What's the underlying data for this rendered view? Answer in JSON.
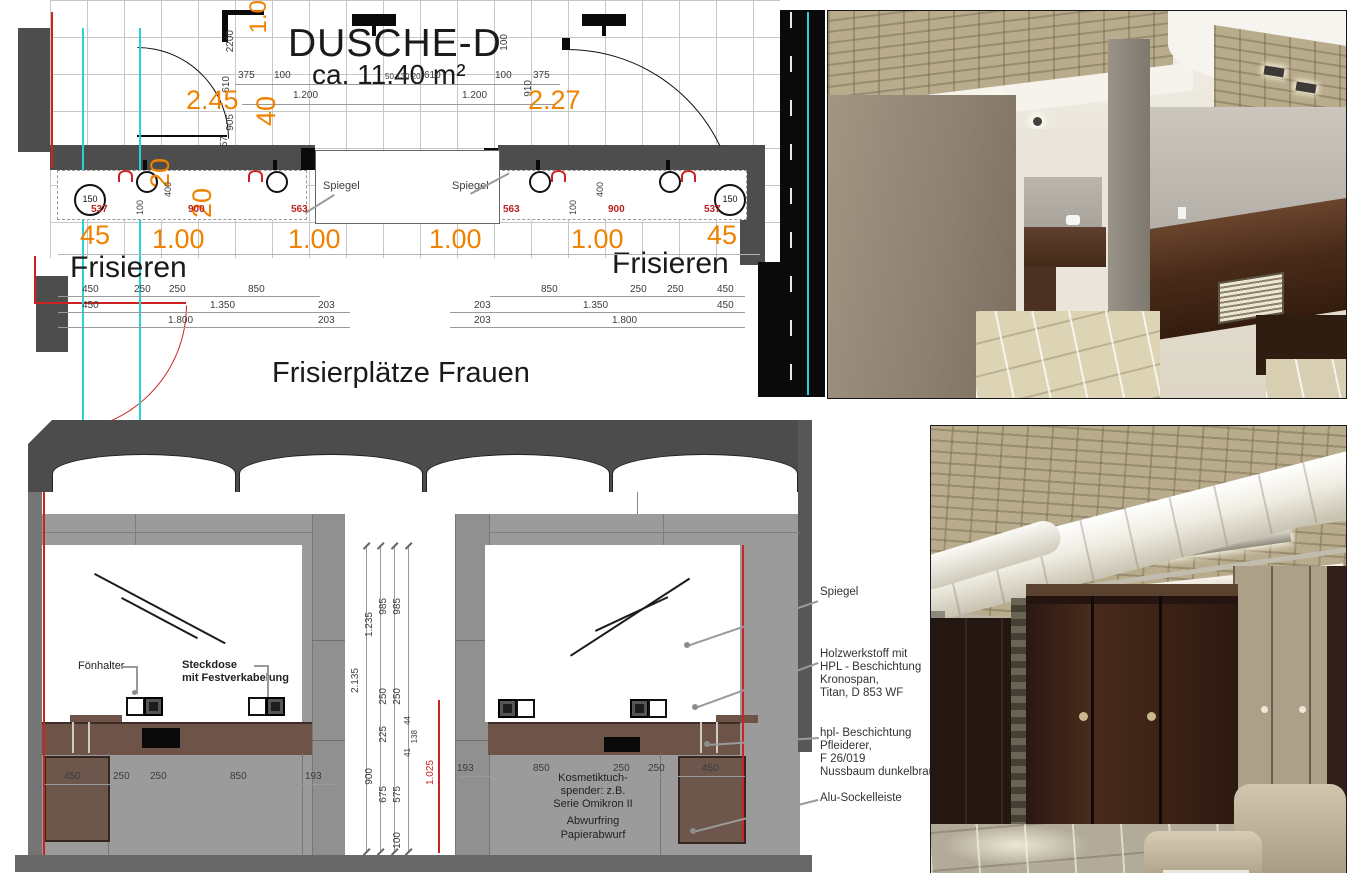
{
  "plan": {
    "title": "DUSCHE-D",
    "area": "ca. 11.40 m²",
    "frisieren_left": "Frisieren",
    "frisieren_right": "Frisieren",
    "caption": "Frisierplätze Frauen",
    "spiegel_a": "Spiegel",
    "spiegel_b": "Spiegel",
    "fixture_d_left": "150",
    "fixture_d_right": "150",
    "orange": {
      "left": "2.45",
      "right": "2.27",
      "v1": "1.0",
      "v40": "40",
      "v20a": "20",
      "v20b": "20",
      "b1": "45",
      "b2": "1.00",
      "b3": "1.00",
      "b4": "1.00",
      "b5": "1.00",
      "b6": "45"
    },
    "red": {
      "r1": "537",
      "r2": "900",
      "r3": "563",
      "r4": "563",
      "r5": "900",
      "r6": "537"
    },
    "top": {
      "t375l": "375",
      "t100l": "100",
      "t1200l": "1.200",
      "tsm": "50 130 20",
      "t610": "610",
      "t100r": "100",
      "t375r": "375",
      "t1200r": "1.200"
    },
    "vsm": {
      "v2200": "2200",
      "v610": "610",
      "v905": "905",
      "v57": "57",
      "v910": "910",
      "v100": "100",
      "v400l": "400",
      "v100l": "100",
      "v400r": "400",
      "v100r": "100"
    },
    "rows_left": {
      "a1": "450",
      "a2": "250",
      "a3": "250",
      "a4": "850",
      "b1": "450",
      "b2": "1.350",
      "b3": "203",
      "c1": "1.800",
      "c2": "203"
    },
    "rows_right": {
      "a1": "850",
      "a2": "250",
      "a3": "250",
      "a4": "450",
      "b1": "203",
      "b2": "1.350",
      "b3": "450",
      "c1": "203",
      "c2": "1.800"
    }
  },
  "elevation": {
    "foenhalter": "Fönhalter",
    "steckdose1": "Steckdose",
    "steckdose2": "mit Festverkabelung",
    "v": {
      "d2135": "2.135",
      "d1235": "1.235",
      "d985a": "985",
      "d985b": "985",
      "d250a": "250",
      "d250b": "250",
      "d225": "225",
      "d44": "44",
      "d138": "138",
      "d41": "41",
      "d900": "900",
      "d675": "675",
      "d575": "575",
      "d100": "100",
      "d1025": "1.025"
    },
    "hl": {
      "h1": "450",
      "h2": "250",
      "h3": "250",
      "h4": "850",
      "h5": "193"
    },
    "hr": {
      "h1": "193",
      "h2": "850",
      "h3": "250",
      "h4": "250",
      "h5": "450"
    },
    "note1": "Kosmetiktuch-",
    "note2": "spender: z.B.",
    "note3": "Serie Omikron II",
    "note4": "Abwurfring",
    "note5": "Papierabwurf"
  },
  "callouts": {
    "spiegel": "Spiegel",
    "holz1": "Holzwerkstoff mit",
    "holz2": "HPL - Beschichtung",
    "holz3": "Kronospan,",
    "holz4": "Titan, D 853 WF",
    "hpl1": "hpl- Beschichtung",
    "hpl2": "Pfleiderer,",
    "hpl3": "F 26/019",
    "hpl4": "Nussbaum dunkelbraun",
    "alu": "Alu-Sockelleiste"
  },
  "colors": {
    "orange": "#f08200",
    "red": "#cc2222",
    "cyan": "#27d2d4",
    "wall_dark": "#4d4d4d",
    "elevation_gray": "#9b9b9b",
    "counter_brown": "#6e5448",
    "cabinet_brown": "#6d564c"
  }
}
